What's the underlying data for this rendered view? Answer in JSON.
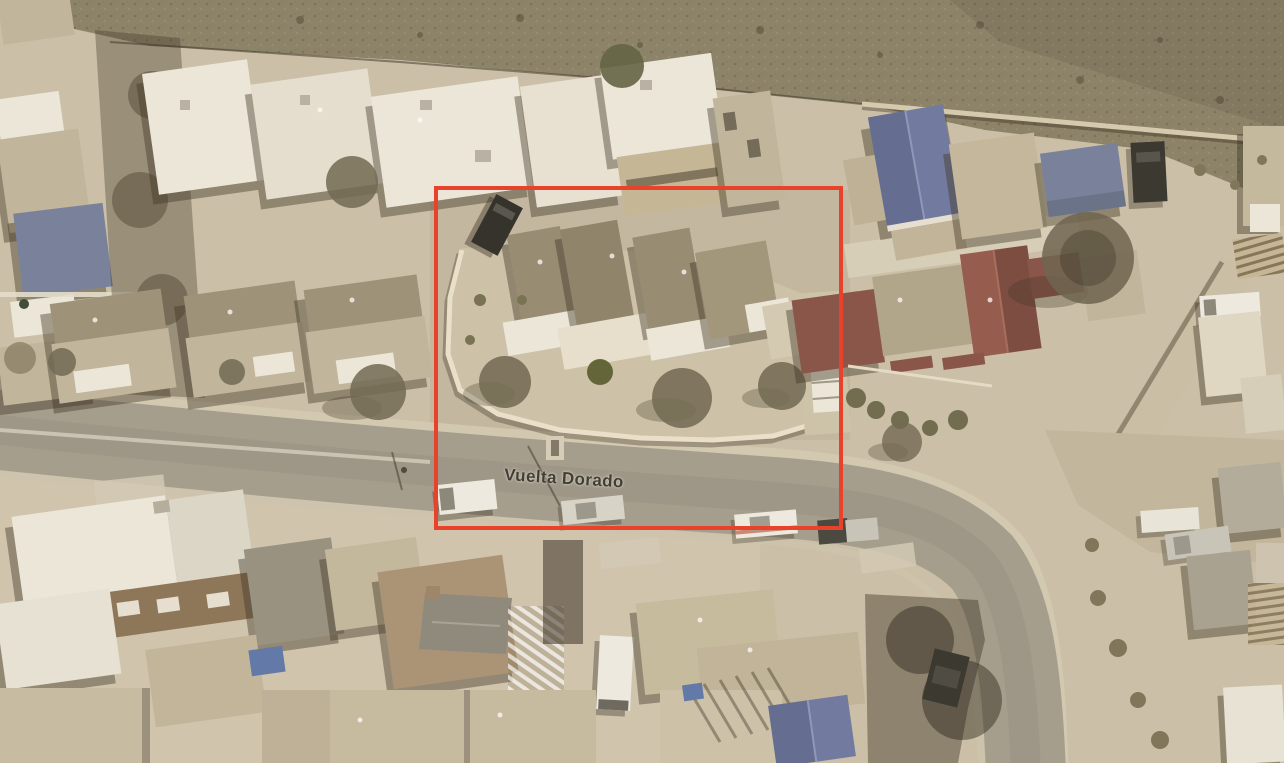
{
  "scene": {
    "type": "aerial-birds-eye-photo",
    "description": "Bird's-eye aerial photo of a desert residential neighborhood with a property outlined in red along Vuelta Dorado street",
    "street_label": "Vuelta Dorado"
  },
  "highlight": {
    "x": 434,
    "y": 186,
    "width": 409,
    "height": 344,
    "thickness": 4,
    "color": "#e8432a"
  },
  "colors": {
    "ground": "#cdc1a8",
    "desert": "#8b8166",
    "road": "#a59d8d",
    "sidewalk": "#d6ccb4",
    "roof_white": "#eee9db",
    "roof_cream": "#e7e1d1",
    "roof_tan": "#c2b69b",
    "roof_dark_tan": "#9e9176",
    "roof_unit": "#978b70",
    "roof_gray": "#98917f",
    "roof_blue": "#5f6b94",
    "roof_blue_light": "#6d79a3",
    "roof_slate": "#76809e",
    "roof_maroon": "#8a5146",
    "wall_brown": "#8d7355",
    "house_brown": "#ab9273",
    "shadow": "rgba(58,48,32,0.42)",
    "tree": "#6f6650",
    "tree_olive": "#5f6234",
    "car_dark": "#2f2d28",
    "car_white": "#f0ede3",
    "car_silver": "#c9c6ba",
    "highlight": "#e8432a",
    "label": "#403e39"
  }
}
